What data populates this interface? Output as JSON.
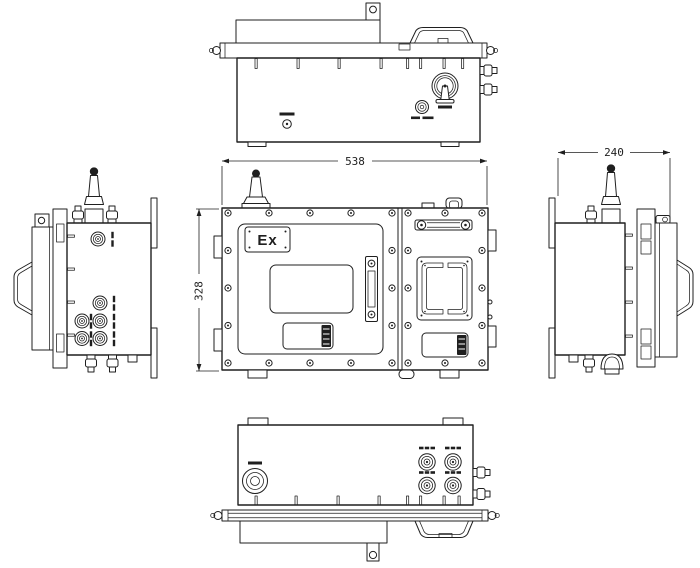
{
  "figure": {
    "type": "orthographic-engineering-drawing",
    "subject": "flameproof enclosure, five views",
    "views": [
      "top-view",
      "front-view",
      "left-side-view",
      "right-side-view",
      "bottom-view"
    ]
  },
  "labels": {
    "width": "538",
    "height": "328",
    "depth": "240",
    "ex_marking": "Ex"
  },
  "colors": {
    "background": "#ffffff",
    "line": "#1f1f1f"
  }
}
